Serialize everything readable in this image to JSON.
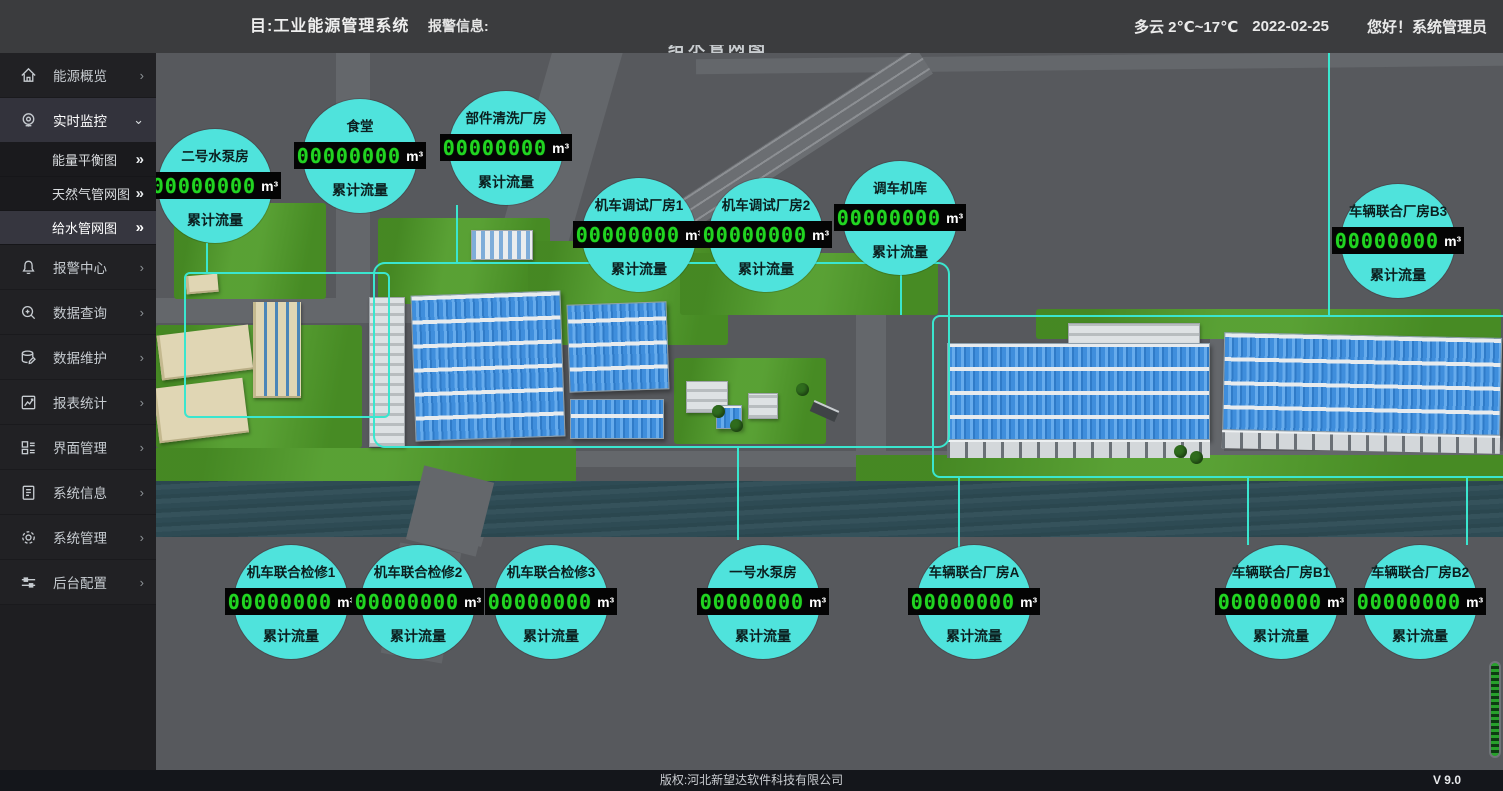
{
  "header": {
    "title": "目:工业能源管理系统",
    "alarm_label": "报警信息:",
    "weather": "多云 2℃~17℃",
    "date": "2022-02-25",
    "greeting": "您好！系统管理员"
  },
  "map": {
    "clipped_title": "给水管网图"
  },
  "sidebar": {
    "collapse_arrow": "›",
    "expand_arrow": "⌄",
    "submenu_arrow": "»",
    "items": [
      {
        "label": "能源概览",
        "icon": "home-icon"
      },
      {
        "label": "实时监控",
        "icon": "monitor-icon",
        "active": true,
        "expanded": true
      },
      {
        "label": "报警中心",
        "icon": "bell-icon"
      },
      {
        "label": "数据查询",
        "icon": "search-icon"
      },
      {
        "label": "数据维护",
        "icon": "database-icon"
      },
      {
        "label": "报表统计",
        "icon": "chart-icon"
      },
      {
        "label": "界面管理",
        "icon": "grid-icon"
      },
      {
        "label": "系统信息",
        "icon": "document-icon"
      },
      {
        "label": "系统管理",
        "icon": "gear-icon"
      },
      {
        "label": "后台配置",
        "icon": "sliders-icon"
      }
    ],
    "submenu": [
      {
        "label": "能量平衡图"
      },
      {
        "label": "天然气管网图"
      },
      {
        "label": "给水管网图",
        "selected": true
      }
    ]
  },
  "badges": {
    "value": "00000000",
    "unit": "m³",
    "flow_label": "累计流量",
    "top": [
      {
        "name": "二号水泵房"
      },
      {
        "name": "食堂"
      },
      {
        "name": "部件清洗厂房"
      },
      {
        "name": "机车调试厂房1"
      },
      {
        "name": "机车调试厂房2"
      },
      {
        "name": "调车机库"
      },
      {
        "name": "车辆联合厂房B3"
      }
    ],
    "bottom": [
      {
        "name": "机车联合检修1"
      },
      {
        "name": "机车联合检修2"
      },
      {
        "name": "机车联合检修3"
      },
      {
        "name": "一号水泵房"
      },
      {
        "name": "车辆联合厂房A"
      },
      {
        "name": "车辆联合厂房B1"
      },
      {
        "name": "车辆联合厂房B2"
      }
    ]
  },
  "footer": {
    "copyright": "版权:河北新望达软件科技有限公司",
    "version": "V 9.0"
  },
  "colors": {
    "badge_cyan": "#4FE3DC",
    "lcd_green": "#21D421",
    "pipe_cyan": "#3AE6CF",
    "grass_green": "#4F9B28",
    "river_teal": "#315059",
    "roof_blue": "#3F8EDC"
  }
}
